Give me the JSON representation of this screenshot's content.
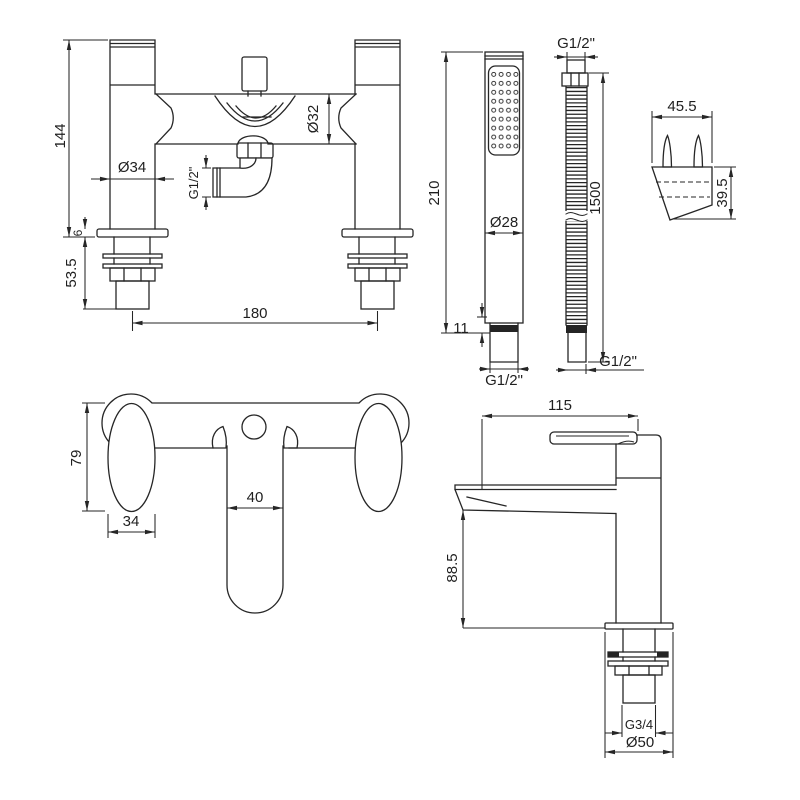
{
  "drawing": {
    "line_color": "#262626",
    "views": {
      "mixer_front": {
        "title": "bath-shower-mixer-front-view",
        "dims": {
          "height": "144",
          "deck": "6",
          "tail": "53.5",
          "centres": "180",
          "pillar_dia": "Ø34",
          "body_dia": "Ø32",
          "outlet_thread": "G1/2\""
        }
      },
      "handset": {
        "title": "hand-shower-view",
        "dims": {
          "length": "210",
          "head_dia": "Ø28",
          "collar": "11",
          "connector_thread": "G1/2\""
        }
      },
      "hose": {
        "title": "shower-hose-view",
        "dims": {
          "top_thread": "G1/2\"",
          "length": "1500",
          "bottom_thread": "G1/2\""
        }
      },
      "bracket": {
        "title": "wall-bracket-view",
        "dims": {
          "width": "45.5",
          "height": "39.5"
        }
      },
      "mixer_top": {
        "title": "mixer-plan-view",
        "dims": {
          "handle_length": "79",
          "handle_width": "34",
          "spout_width": "40"
        }
      },
      "basin_side": {
        "title": "basin-tap-side-view",
        "dims": {
          "reach": "115",
          "height": "88.5",
          "tail_thread": "G3/4",
          "base_dia": "Ø50"
        }
      }
    }
  }
}
